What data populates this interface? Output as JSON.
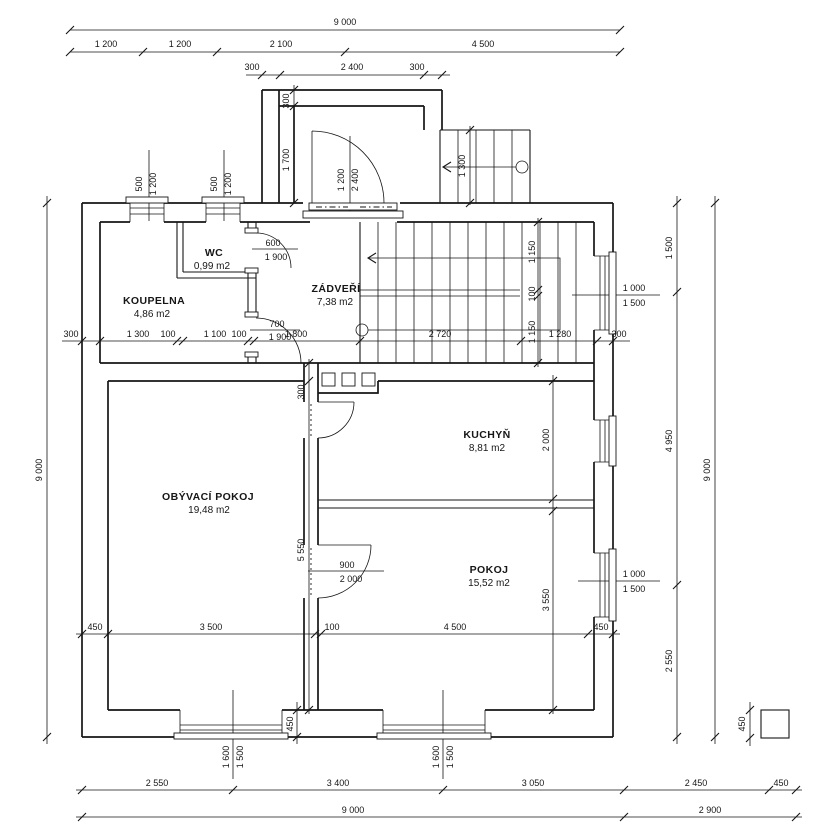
{
  "rooms": {
    "koupelna": {
      "name": "KOUPELNA",
      "area": "4,86 m2"
    },
    "wc": {
      "name": "WC",
      "area": "0,99 m2"
    },
    "zadveri": {
      "name": "ZÁDVEŘÍ",
      "area": "7,38 m2"
    },
    "kuchyn": {
      "name": "KUCHYŇ",
      "area": "8,81 m2"
    },
    "obyvaci": {
      "name": "OBÝVACÍ POKOJ",
      "area": "19,48 m2"
    },
    "pokoj": {
      "name": "POKOJ",
      "area": "15,52 m2"
    }
  },
  "dims": {
    "top_total": "9 000",
    "top_row": [
      "1 200",
      "1 200",
      "2 100",
      "4 500"
    ],
    "porch_row": [
      "300",
      "2 400",
      "300"
    ],
    "porch_side": [
      "300",
      "1 700"
    ],
    "entry_door": [
      "1 200",
      "2 400"
    ],
    "outdoor_stair_width": "1 300",
    "small_window": [
      "500",
      "1 200"
    ],
    "left_total": "9 000",
    "right_row": [
      "1 500",
      "4 950",
      "2 550"
    ],
    "right_total": "9 000",
    "pier": "450",
    "mid_row": [
      "300",
      "1 300",
      "100",
      "1 100",
      "100",
      "1 800",
      "2 720",
      "1 280",
      "300"
    ],
    "stair_row": [
      "1 150",
      "100",
      "1 150"
    ],
    "wc_door": [
      "600",
      "1 900"
    ],
    "bath_door": [
      "700",
      "1 900"
    ],
    "room_door": [
      "900",
      "2 000"
    ],
    "living_col": [
      "300",
      "5 550"
    ],
    "kitchen_col": [
      "2 000",
      "3 550"
    ],
    "side_window": [
      "1 000",
      "1 500"
    ],
    "bottom_inner_row": [
      "450",
      "3 500",
      "100",
      "4 500",
      "450"
    ],
    "bottom_wall": "450",
    "bottom_window": [
      "1 600",
      "1 500"
    ],
    "bottom_row1": [
      "2 550",
      "3 400",
      "3 050",
      "2 450",
      "450"
    ],
    "bottom_row2": [
      "9 000",
      "2 900"
    ]
  }
}
